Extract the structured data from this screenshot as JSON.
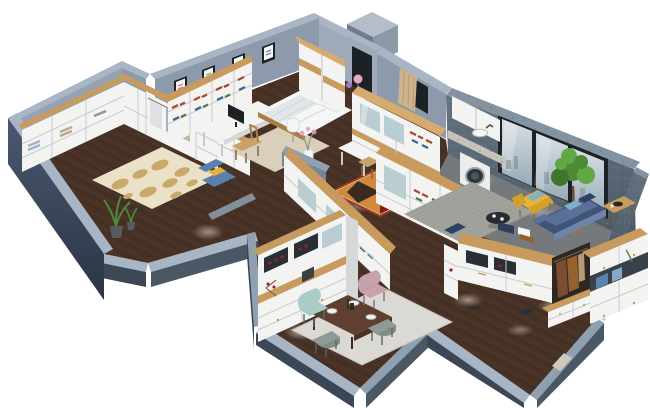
{
  "image": {
    "kind": "3d-isometric-apartment-floorplan-render",
    "background": "#ffffff"
  },
  "rooms": [
    {
      "name": "walk-in-closet",
      "items": [
        "l-shaped-white-wardrobes",
        "wood-countertop",
        "hanging-clothes",
        "cream-oval-pattern-rug",
        "blue-armchair-yellow-pillow",
        "potted-plant"
      ]
    },
    {
      "name": "bedroom",
      "items": [
        "corner-bookshelf",
        "desk-with-monitor",
        "wood-chair",
        "beige-rug",
        "double-bed-white-bedding",
        "pillows",
        "nightstand",
        "pink-ball-lamp",
        "purple-ball-lamp",
        "four-framed-pictures",
        "sliding-door-wardrobe",
        "dark-doorway",
        "paper-floor-lamp"
      ]
    },
    {
      "name": "study",
      "items": [
        "white-corner-desk",
        "wood-chair",
        "red-geometric-rug",
        "bookcase-partition-wall",
        "vase-with-pink-flowers"
      ]
    },
    {
      "name": "kitchen-laundry",
      "items": [
        "glass-front-cabinet-run",
        "wood-counter-band",
        "upper-cabinets",
        "marble-counter",
        "sink",
        "washing-machine",
        "curtained-window"
      ]
    },
    {
      "name": "balcony-living-room",
      "items": [
        "concrete-texture-walls",
        "three-pane-panoramic-window",
        "gray-tile-floor",
        "potted-tree",
        "gray-striped-rug",
        "blue-sofa-with-pillows",
        "yellow-armchair-teal-pillow",
        "round-black-coffee-table",
        "wood-side-table",
        "navy-floor-cushion"
      ]
    },
    {
      "name": "dining-room",
      "items": [
        "white-wine-cabinet-wood-counter",
        "wine-bottles",
        "dark-wood-dining-table",
        "white-plates",
        "teal-chair",
        "pink-chair",
        "gray-chair",
        "gray-chair",
        "light-area-rug"
      ]
    },
    {
      "name": "entryway",
      "items": [
        "l-shaped-hall-closet",
        "coat-nook-with-coats",
        "shoe-bench-drawers",
        "tall-white-cabinet",
        "folded-clothes-on-top",
        "entry-door-threshold"
      ]
    }
  ],
  "lighting": [
    "recessed-ceiling-spotlight-pools"
  ],
  "palette": {
    "bg": "#ffffff",
    "rim": "#a7b5c4",
    "rimmid": "#8fa0b1",
    "rimlight": "#b9c5d2",
    "wallint": "#8d9aab",
    "wallintlight": "#9fabba",
    "wallface": "#95a2b1",
    "slate": "#3c4756",
    "slatelight": "#4a5765",
    "walldark1": "#4b5870",
    "walldark2": "#2a3444",
    "texwall1": "#64737f",
    "texwall2": "#4b5a66",
    "texcap": "#8493a2",
    "wood": "#c89a5e",
    "wooddark": "#a87c44",
    "woodlight": "#d7ab6e",
    "floor": "#483226",
    "plank": "#2e211a",
    "planklight": "#5a4334",
    "tile": "#75797b",
    "tileline": "#616e77",
    "cab": "#f3f3f1",
    "cabshade": "#dfe1e0",
    "cabside": "#d6d8d7",
    "glassteal": "#b9ced2",
    "glasswin1": "#d9e1e5",
    "glasswin2": "#98aab6",
    "framedark": "#1c2126",
    "rugcream": "#ebe1c6",
    "rugspot": "#c9a96b",
    "rugbeige": "#d9cfba",
    "rugred": "#a33a22",
    "rugreddark": "#7c2017",
    "rugorange": "#cf8a3b",
    "ruggray": "#a3a39d",
    "ruggrayline": "#8e8e88",
    "rugdining": "#dad9d3",
    "sofa": "#3f5478",
    "sofalight": "#5a7099",
    "sofapale": "#6e84a8",
    "pillowteal": "#7fb0c9",
    "pillownavy": "#2e4165",
    "yellow": "#e6b33a",
    "yellowdark": "#d3a128",
    "tealchair": "#a9ccc9",
    "pinkchair": "#c7a2ad",
    "graychair": "#8f9a95",
    "graychair2": "#828d87",
    "tablewood": "#5f4030",
    "tableedge": "#4c3225",
    "treea": "#4d8a36",
    "treeb": "#61a845",
    "treec": "#3e772c",
    "pot": "#b06a4a",
    "curtain": "#cdb28c",
    "marble": "#c6c3ba",
    "white": "#f5f6f6",
    "washerdoor": "#2e353b",
    "dark": "#2a2f35",
    "coat1": "#7a4e2e",
    "coat2": "#93622f",
    "navyitem": "#2c3e5c",
    "pinklamp": "#e8a7c4",
    "purplelamp": "#9b7fc0",
    "winered": "#8a2030",
    "armblue": "#5b7fae",
    "armyellow": "#e6c23a",
    "plantgreen": "#4e8a38",
    "potgray": "#565c5e"
  }
}
